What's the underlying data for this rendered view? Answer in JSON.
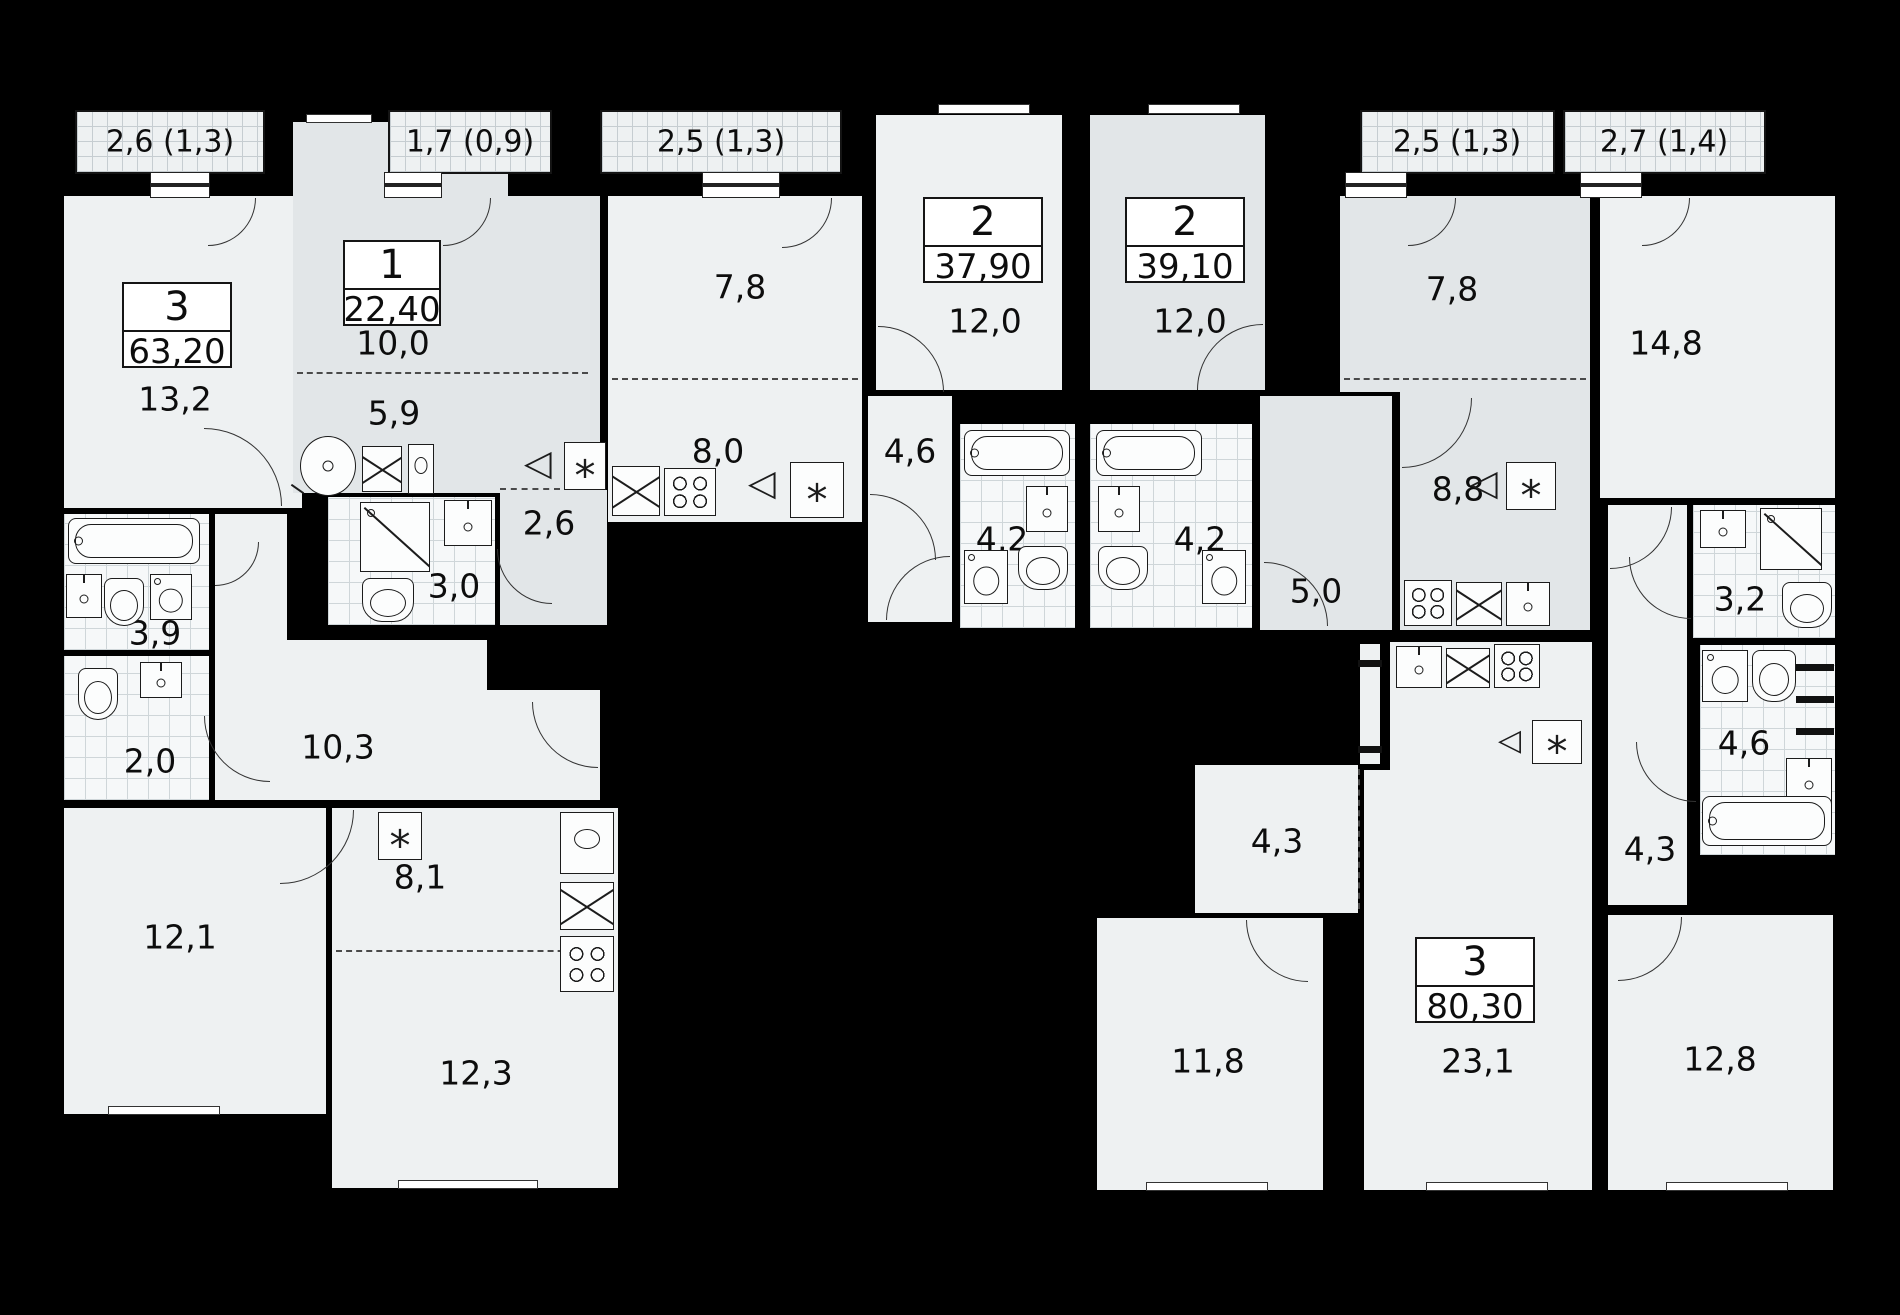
{
  "apartments": [
    {
      "type": "3",
      "area": "63,20",
      "balcony": "2,6 (1,3)",
      "rooms": {
        "living": "13,2",
        "bath": "3,9",
        "wc": "2,0",
        "hall": "10,3",
        "bedroom": "12,1",
        "kitchen": "8,1",
        "kitchen_living": "12,3"
      }
    },
    {
      "type": "1",
      "area": "22,40",
      "balcony": "1,7 (0,9)",
      "rooms": {
        "living": "10,0",
        "kitchen": "5,9",
        "shower": "3,0",
        "storage": "2,6"
      }
    },
    {
      "type": "2",
      "area": "37,90",
      "balcony": "2,5 (1,3)",
      "rooms": {
        "kitchen": "7,8",
        "kitchen_living": "8,0",
        "bedroom": "12,0",
        "hall": "4,6",
        "bath": "4,2"
      }
    },
    {
      "type": "2",
      "area": "39,10",
      "balcony": "2,5 (1,3)",
      "rooms": {
        "bedroom": "12,0",
        "bath": "4,2",
        "hall": "5,0",
        "kitchen": "7,8",
        "kitchen_living": "8,8"
      }
    },
    {
      "type": "3",
      "area": "80,30",
      "balcony": "2,7 (1,4)",
      "rooms": {
        "bedroom_main": "14,8",
        "shower": "3,2",
        "bath": "4,6",
        "hall": "4,3",
        "kitchen_niche": "4,3",
        "living": "23,1",
        "bedroom_2": "11,8",
        "bedroom_3": "12,8"
      }
    }
  ]
}
